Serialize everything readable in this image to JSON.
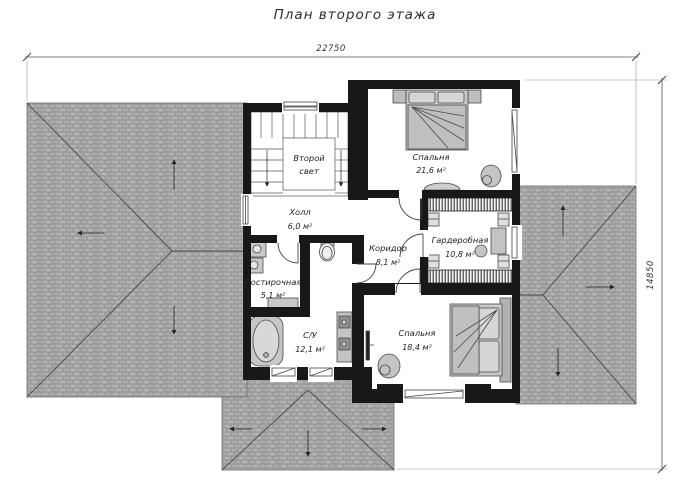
{
  "title": "План второго этажа",
  "dimensions": {
    "top": "22750",
    "right": "14850"
  },
  "rooms": {
    "second_light": {
      "name": "Второй свет",
      "line1": "Второй",
      "line2": "свет"
    },
    "bedroom1": {
      "name": "Спальня",
      "area": "21,6 м²"
    },
    "hall": {
      "name": "Холл",
      "area": "6,0 м²"
    },
    "corridor": {
      "name": "Коридор",
      "area": "8,1 м²"
    },
    "wardrobe": {
      "name": "Гардеробная",
      "area": "10,8 м²"
    },
    "laundry": {
      "name": "Постирочная",
      "area": "5,1 м²"
    },
    "bathroom": {
      "name": "С/У",
      "area": "12,1 м²"
    },
    "bedroom2": {
      "name": "Спальня",
      "area": "18,4 м²"
    }
  },
  "colors": {
    "wall": "#181818",
    "roof": "#a6a6a6",
    "roof_brick": "#b2b2b2",
    "line": "#444444"
  }
}
